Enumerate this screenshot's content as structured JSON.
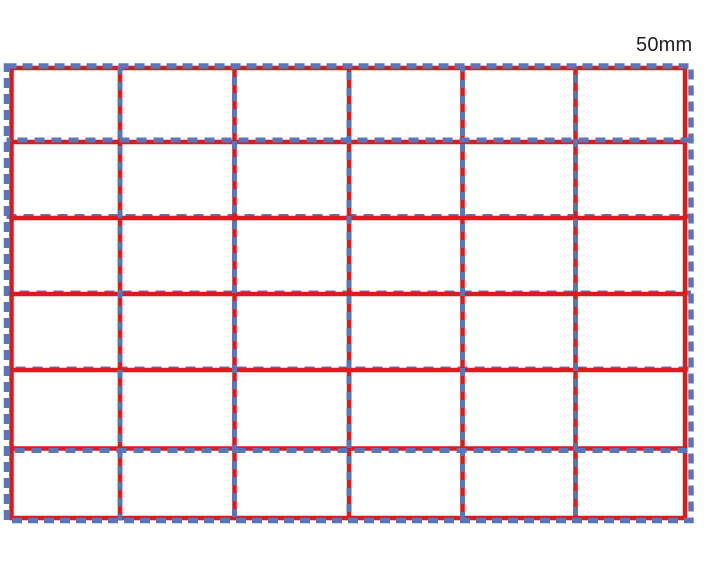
{
  "figure": {
    "dimension_label": "50mm",
    "label_color": "#1f1f1f",
    "background_color": "#ffffff",
    "nominal_grid": {
      "description": "nominal 50mm reference grid",
      "line_style": "dashed",
      "color": "#5b76b8",
      "columns": 6,
      "rows": 6,
      "stroke_width": 5.5,
      "outer_rect": {
        "x1": 6.5,
        "y1": 66,
        "x2": 691,
        "y2": 520.5
      },
      "vertical_lines_x": [
        120,
        234.5,
        349,
        462.5,
        575.5
      ],
      "horizontal_overlay_lines_y": [
        140,
        450.5
      ],
      "horizontal_under_lines_y": [
        216.5,
        293,
        369
      ],
      "dash_outer": "10 6",
      "dash_vertical": "8 8",
      "dash_horizontal": "10 7"
    },
    "printed_grid": {
      "description": "solid red printed grid, 6 x 6 cells",
      "line_style": "solid",
      "color": "#dc1b1f",
      "columns": 6,
      "rows": 6,
      "stroke_width": 4.5,
      "outer_rect": {
        "x1": 11.5,
        "y1": 68,
        "x2": 685,
        "y2": 518
      },
      "vertical_lines_x": [
        120,
        234.5,
        349,
        462.5,
        575.5
      ],
      "horizontal_lines_y": [
        142,
        218,
        294,
        370,
        448.5
      ]
    }
  }
}
